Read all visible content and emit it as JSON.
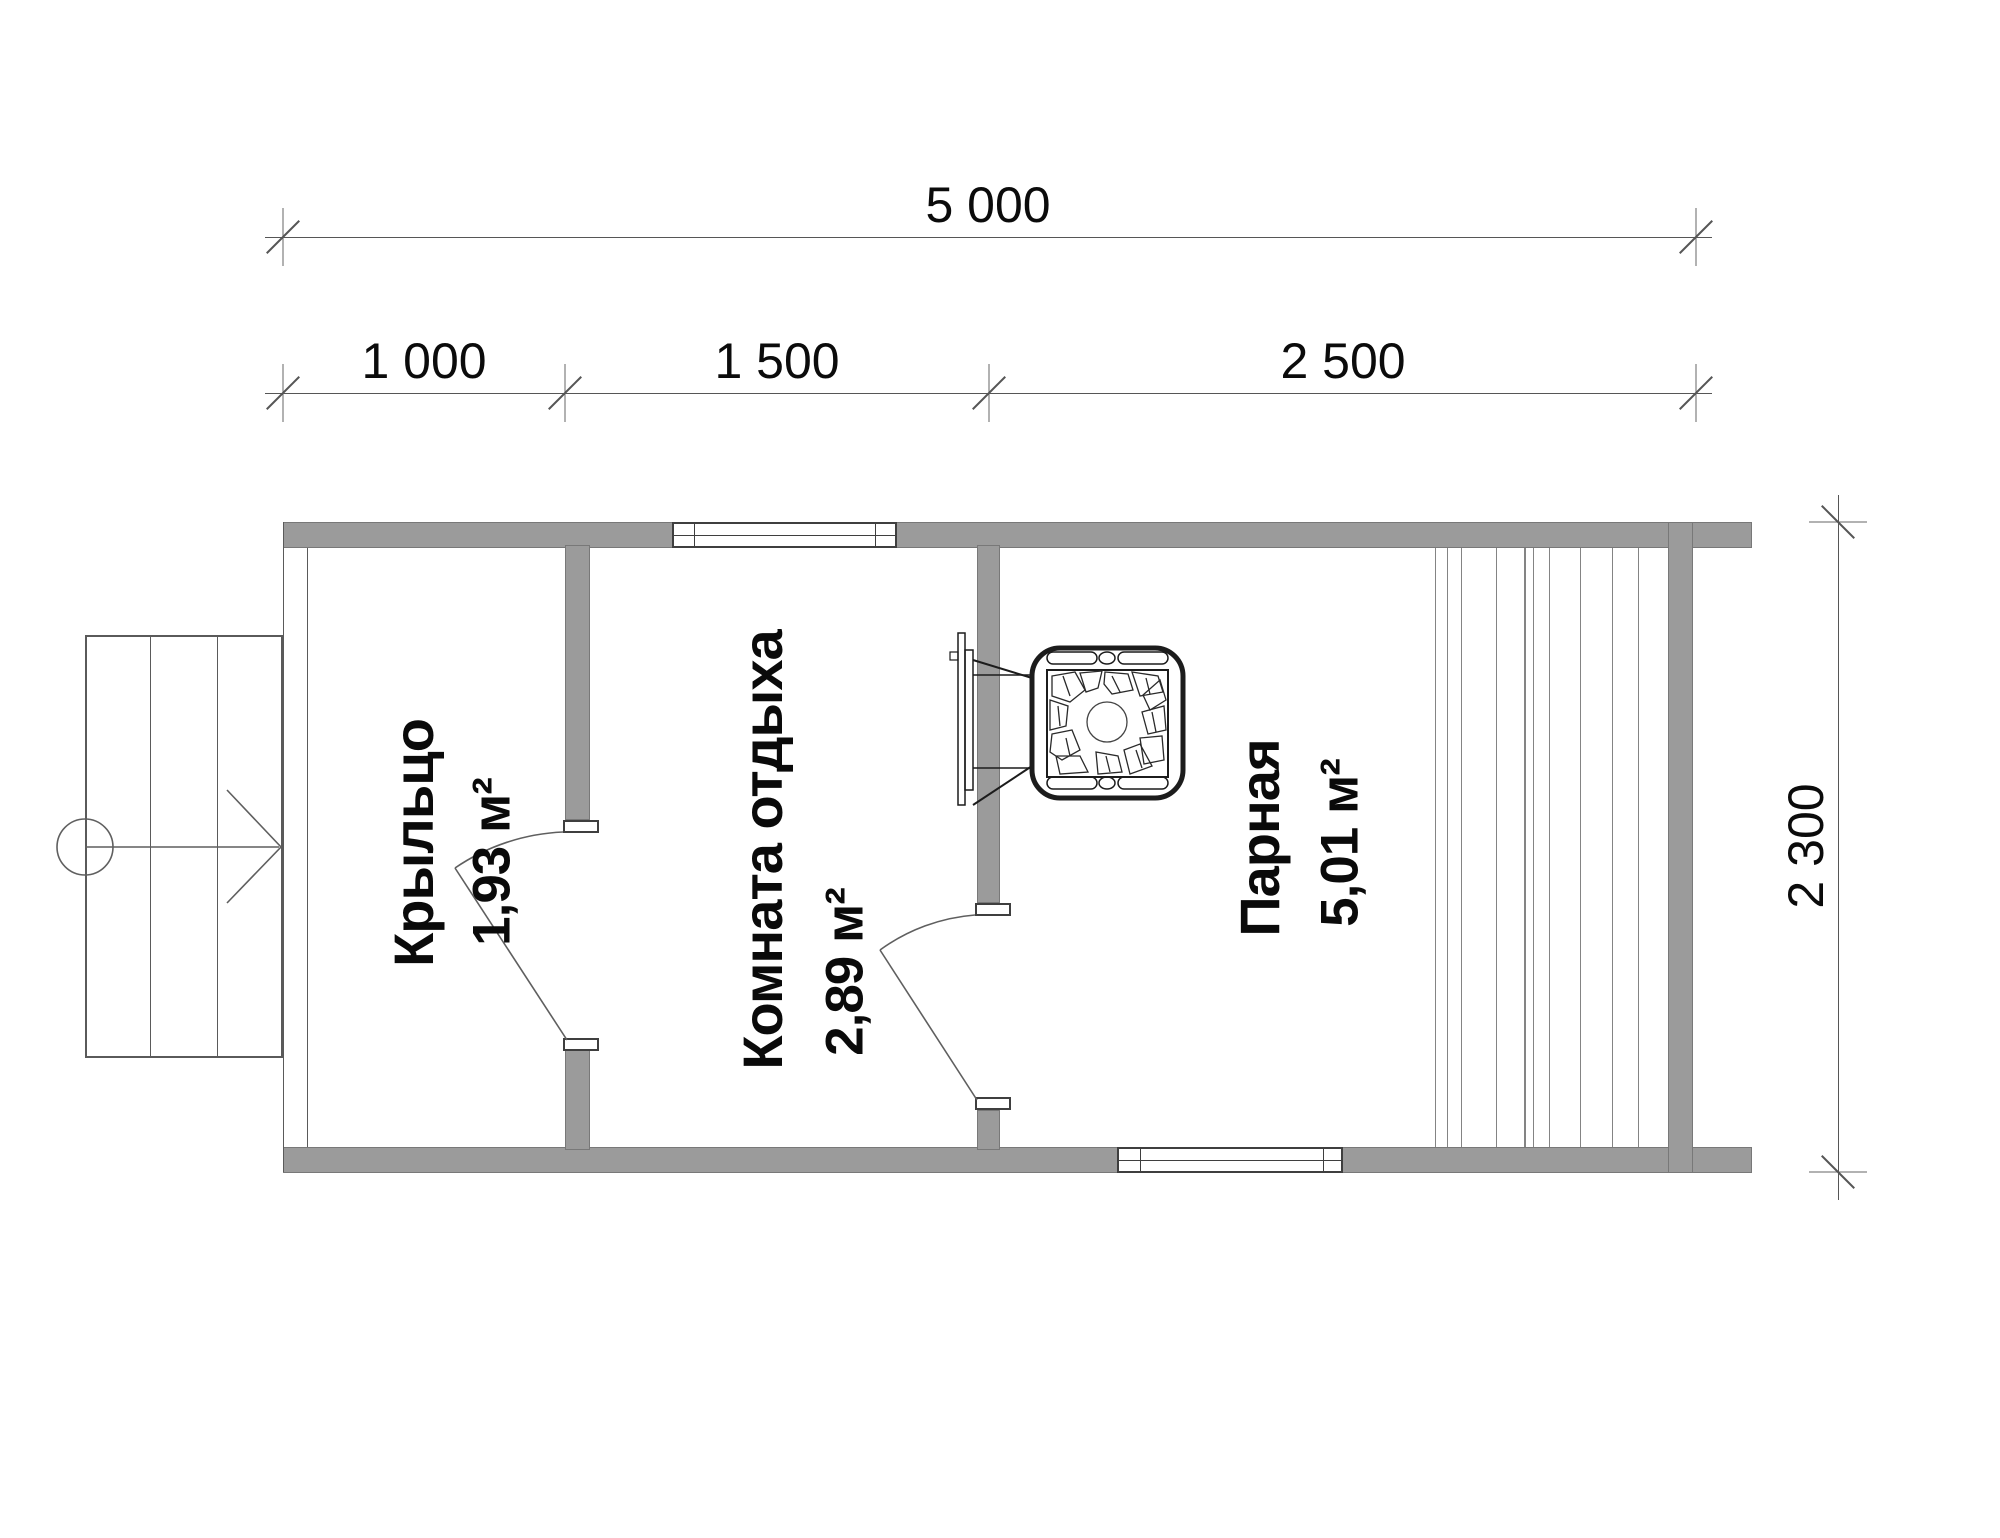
{
  "drawing": {
    "type": "bath-house floor plan",
    "wall_color": "#9b9b9b",
    "rooms": [
      {
        "name": "Крыльцо",
        "area": "1,93 м²"
      },
      {
        "name": "Комната отдыха",
        "area": "2,89 м²"
      },
      {
        "name": "Парная",
        "area": "5,01 м²"
      }
    ],
    "dimensions": {
      "total_width": "5 000",
      "width_segments": [
        "1 000",
        "1 500",
        "2 500"
      ],
      "total_depth": "2 300"
    }
  }
}
